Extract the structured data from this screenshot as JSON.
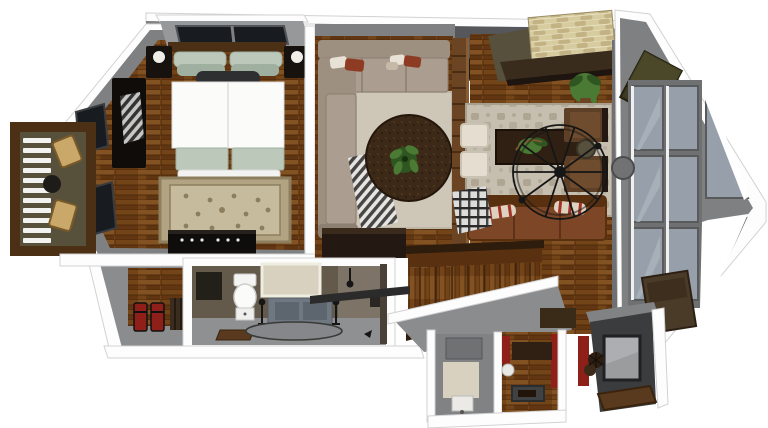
{
  "scene": {
    "type": "3d-floorplan-top-down-render",
    "style": "sketchup-cutaway",
    "rooms": [
      {
        "name": "bedroom",
        "floor": "hardwood",
        "furniture": [
          "double-bed",
          "headboard",
          "sage-pillows",
          "dark-throw-pillow",
          "white-duvet",
          "foot-bench",
          "nightstand-left",
          "nightstand-right",
          "table-lamp-left",
          "table-lamp-right",
          "oriental-rug",
          "wardrobe-with-blanket",
          "media-dresser",
          "skylight-window",
          "angled-wall-windows"
        ]
      },
      {
        "name": "balcony",
        "floor": "wood-deck",
        "furniture": [
          "timber-frame",
          "louvered-railing",
          "deck-chair-upper",
          "deck-chair-lower",
          "round-bistro-table"
        ]
      },
      {
        "name": "living-room",
        "floor": "hardwood",
        "furniture": [
          "l-sectional-sofa",
          "accent-pillows",
          "striped-gray-blanket",
          "beige-area-rug",
          "round-plant-rug",
          "center-plant",
          "media-credenza",
          "round-floor-lamp",
          "wood-slat-divider"
        ]
      },
      {
        "name": "great-room",
        "floor": "hardwood",
        "furniture": [
          "stone-accent-wall",
          "dark-mantel-ledge",
          "roof-skylights",
          "potted-plant",
          "patterned-area-rug",
          "coffee-table",
          "table-plant",
          "cream-side-chairs",
          "brown-armchair-upper",
          "brown-armchair-lower",
          "round-side-table",
          "leather-sofa",
          "striped-sofa-pillows",
          "plaid-blanket",
          "wire-orb-chandelier"
        ]
      },
      {
        "name": "bay-window-prow",
        "features": [
          "angled-roofline",
          "mullioned-window-grid",
          "angled-corner-panes",
          "roof-window-panel",
          "fan-hub"
        ]
      },
      {
        "name": "bathroom",
        "floor": "tile",
        "furniture": [
          "toilet",
          "toilet-drawer-stand",
          "bath-mat",
          "framed-mirror",
          "concrete-vanity",
          "sprayer-stands",
          "oval-rug",
          "wall-sconce",
          "door-frame",
          "dark-wall-cabinet"
        ]
      },
      {
        "name": "entry-closet",
        "furniture": [
          "wood-panel-wall",
          "shoe-rack",
          "storage-crate",
          "red-gear-pair",
          "stud-framing"
        ]
      },
      {
        "name": "staircase",
        "furniture": [
          "wood-treads",
          "upper-handrail",
          "lower-handrail",
          "black-handrail-bar",
          "round-wall-lamp"
        ]
      },
      {
        "name": "lower-level",
        "furniture": [
          "utility-room",
          "sink-box",
          "soap-unit",
          "beige-floor-tile",
          "storage-room",
          "wall-shelf",
          "floor-hatch",
          "white-round-fixture",
          "red-accent-strips"
        ]
      },
      {
        "name": "fireplace-nook",
        "furniture": [
          "charcoal-surround",
          "glass-firebox",
          "pinecone-decor",
          "hearth-mat",
          "red-accent-wall",
          "brown-ledge",
          "angled-wall-art-panel"
        ]
      }
    ]
  },
  "colors": {
    "canvas_white": "#ffffff",
    "trim_white": "#fdfdfd",
    "trim_shadow": "#d2d2d2",
    "wall_gray": "#7e8082",
    "wall_gray_dark": "#55575a",
    "wall_gray_light": "#96989a",
    "ink": "#161616",
    "wood_light": "#8f5c2c",
    "wood_mid": "#744419",
    "wood_dark": "#5a3110",
    "wood_deep": "#472508",
    "timber": "#4b3016",
    "divider_wood": "#6b4423",
    "balcony_floor": "#57513b",
    "stone_base": "#d7cc9f",
    "stone_dark": "#c2b284",
    "stone_mortar": "#e9e1c1",
    "mantel_dark": "#3a2c1d",
    "olive_band": "#57503c",
    "sofa_taupe": "#9d9081",
    "sofa_taupe_light": "#ab9e90",
    "sofa_taupe_dark": "#81746",
    "rug_beige": "#cec7b8",
    "rug_great": "#c6bfb0",
    "rug_motif": "#a89f8c",
    "round_rug": "#3c2918",
    "rug_ornate": "#b2a483",
    "rug_ornate_border": "#8d7f5e",
    "rug_ornate_light": "#c7bb9e",
    "plant_green": "#4a7a33",
    "plant_dark": "#2f5520",
    "leather": "#7c4627",
    "leather_dark": "#59300f",
    "chair_brown": "#5d4026",
    "chair_brown_light": "#6f4c2e",
    "sage": "#bcc8ba",
    "sage_dark": "#9fb0a0",
    "duvet_white": "#fbfbfa",
    "glass_blue": "#97a0aa",
    "glass_light": "#aeb6bf",
    "window_dark": "#181b1f",
    "bath_wall": "#645a4c",
    "bath_wall_light": "#7d7366",
    "floor_gray": "#8e9092",
    "slab_gray": "#8a8c8e",
    "tile_beige": "#d8d1c0",
    "charcoal": "#3b3c3d",
    "firebox_gray": "#9a9c9e",
    "red_accent": "#8e2019",
    "cream_chair": "#e5ded0",
    "lamp_white": "#f0ede6",
    "shoe_colors": "#c53a6e,#2aa8a0,#7a4ec0,#1c1c1c,#d04a2a,#3a6fd0,#888888"
  }
}
